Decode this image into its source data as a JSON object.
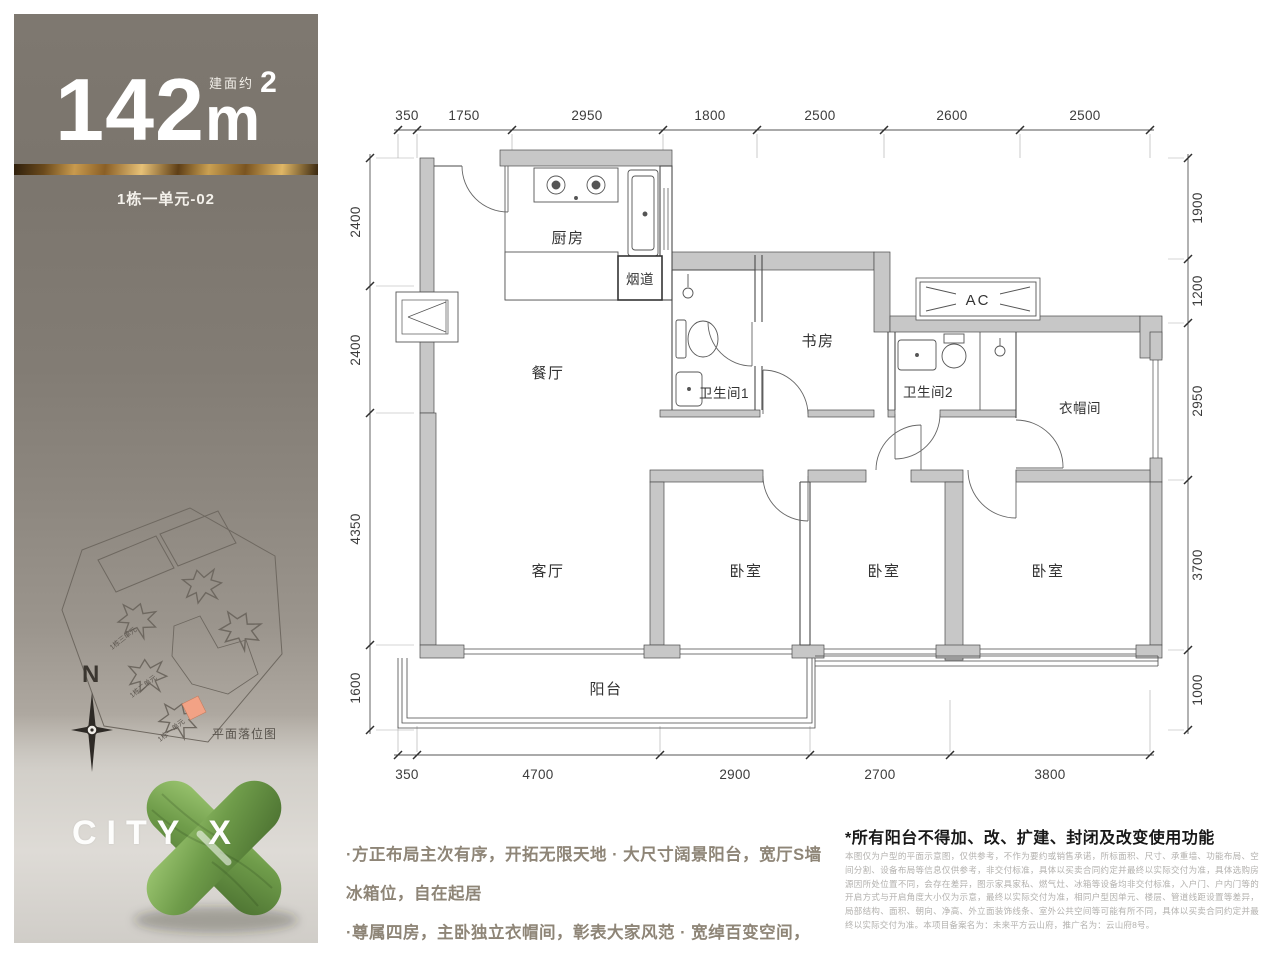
{
  "sidebar": {
    "area": {
      "prefix": "建面约",
      "value": "142",
      "unit": "m",
      "sup": "2"
    },
    "unit_label": "1栋一单元-02",
    "compass_label": "N",
    "site_plan": {
      "caption": "平面落位图",
      "labels": [
        "1栋三单元",
        "1栋二单元",
        "1栋一单元"
      ]
    },
    "logo_text": "CITY X",
    "colors": {
      "background_top": "#7b756d",
      "gold_accent": "#c89a4e",
      "logo_green": "#6f9c4a",
      "highlight_unit": "#f2a285"
    }
  },
  "plan": {
    "rooms": {
      "kitchen": "厨房",
      "flue": "烟道",
      "dining": "餐厅",
      "bath1": "卫生间1",
      "study": "书房",
      "bath2": "卫生间2",
      "ac": "AC",
      "cloakroom": "衣帽间",
      "living": "客厅",
      "bedroom": "卧室",
      "balcony": "阳台"
    },
    "dims_top": [
      "350",
      "1750",
      "2950",
      "1800",
      "2500",
      "2600",
      "2500"
    ],
    "dims_bottom": [
      "350",
      "4700",
      "2900",
      "2700",
      "3800"
    ],
    "dims_left": [
      "2400",
      "2400",
      "4350",
      "1600"
    ],
    "dims_right": [
      "1900",
      "1200",
      "2950",
      "3700",
      "1000"
    ]
  },
  "footer": {
    "bullets": [
      "·方正布局主次有序，开拓无限天地 · 大尺寸阔景阳台，宽厅S墙冰箱位，自在起居",
      "·尊属四房，主卧独立衣帽间，彰表大家风范 · 宽绰百变空间，动静分区，生活自在流畅"
    ],
    "disclaimer_title": "*所有阳台不得加、改、扩建、封闭及改变使用功能",
    "disclaimer_body": "本图仅为户型的平面示意图，仅供参考，不作为要约或销售承诺，所标面积、尺寸、承重墙、功能布局、空间分割、设备布局等信息仅供参考，非交付标准，具体以买卖合同约定并最终以实际交付为准，具体选购房源因所处位置不同，会存在差异，图示家具家私、燃气灶、冰箱等设备均非交付标准，入户门、户内门等的开启方式与开启角度大小仅为示意，最终以实际交付为准，相同户型因单元、楼层、管道线距设置等差异，局部结构、面积、朝向、净高、外立面装饰线条、室外公共空间等可能有所不同，具体以买卖合同约定并最终以实际交付为准。本项目备案名为：未来平方云山府，推广名为：云山府8号。"
  }
}
